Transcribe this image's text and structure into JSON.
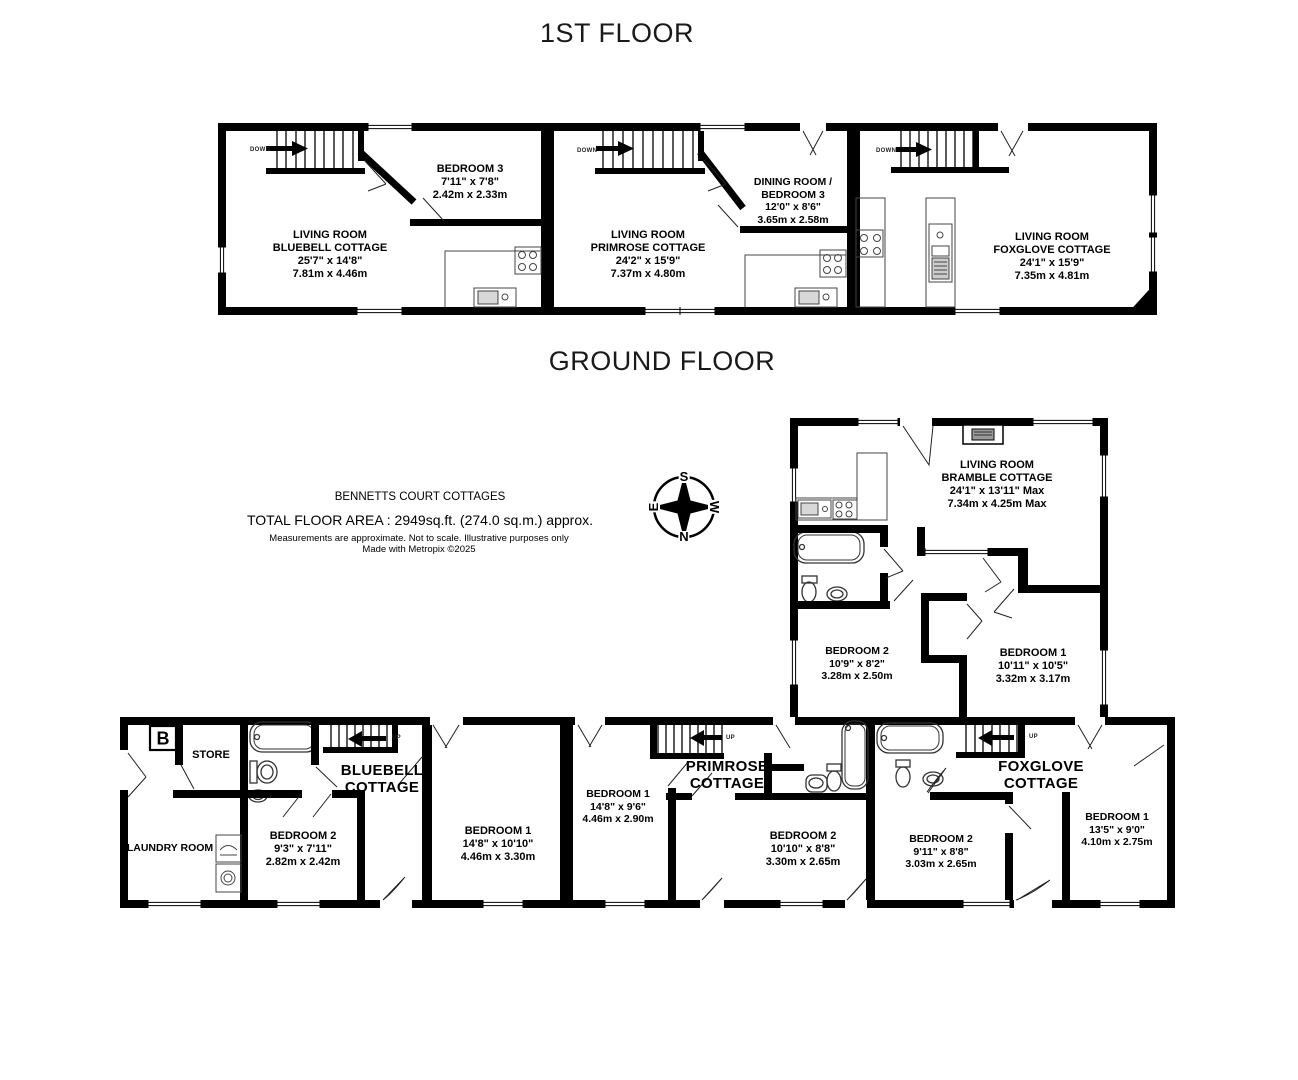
{
  "titles": {
    "first_floor": "1ST FLOOR",
    "ground_floor": "GROUND FLOOR"
  },
  "info": {
    "property_name": "BENNETTS COURT COTTAGES",
    "total_area": "TOTAL FLOOR AREA : 2949sq.ft. (274.0 sq.m.) approx.",
    "disclaimer": "Measurements are approximate.  Not to scale.  Illustrative purposes only",
    "credit": "Made with Metropix ©2025"
  },
  "compass": {
    "north": "N",
    "south": "S",
    "east": "E",
    "west": "W"
  },
  "stairs": {
    "down": "DOWN",
    "up": "UP"
  },
  "boiler": {
    "label": "B"
  },
  "first_floor": {
    "bluebell_living": {
      "lines": [
        "LIVING ROOM",
        "BLUEBELL COTTAGE",
        "25'7\"  x 14'8\"",
        "7.81m  x 4.46m"
      ]
    },
    "bluebell_bedroom3": {
      "lines": [
        "BEDROOM 3",
        "7'11\"  x 7'8\"",
        "2.42m  x 2.33m"
      ]
    },
    "primrose_living": {
      "lines": [
        "LIVING ROOM",
        "PRIMROSE COTTAGE",
        "24'2\"  x 15'9\"",
        "7.37m  x 4.80m"
      ]
    },
    "primrose_dining": {
      "lines": [
        "DINING ROOM /",
        "BEDROOM 3",
        "12'0\"  x 8'6\"",
        "3.65m  x 2.58m"
      ]
    },
    "foxglove_living": {
      "lines": [
        "LIVING ROOM",
        "FOXGLOVE COTTAGE",
        "24'1\"  x 15'9\"",
        "7.35m  x 4.81m"
      ]
    }
  },
  "ground_floor": {
    "bramble_living": {
      "lines": [
        "LIVING ROOM",
        "BRAMBLE COTTAGE",
        "24'1\"  x 13'11\" Max",
        "7.34m  x 4.25m Max"
      ]
    },
    "bramble_bedroom2": {
      "lines": [
        "BEDROOM 2",
        "10'9\"  x 8'2\"",
        "3.28m  x 2.50m"
      ]
    },
    "bramble_bedroom1": {
      "lines": [
        "BEDROOM 1",
        "10'11\"  x 10'5\"",
        "3.32m  x 3.17m"
      ]
    },
    "store": {
      "lines": [
        "STORE"
      ]
    },
    "laundry": {
      "lines": [
        "LAUNDRY ROOM"
      ]
    },
    "bluebell_name": {
      "lines": [
        "BLUEBELL",
        "COTTAGE"
      ]
    },
    "bluebell_bedroom2": {
      "lines": [
        "BEDROOM 2",
        "9'3\"  x 7'11\"",
        "2.82m  x 2.42m"
      ]
    },
    "bluebell_bedroom1": {
      "lines": [
        "BEDROOM 1",
        "14'8\"  x 10'10\"",
        "4.46m  x 3.30m"
      ]
    },
    "primrose_bedroom1": {
      "lines": [
        "BEDROOM 1",
        "14'8\"  x 9'6\"",
        "4.46m  x 2.90m"
      ]
    },
    "primrose_name": {
      "lines": [
        "PRIMROSE",
        "COTTAGE"
      ]
    },
    "primrose_bedroom2": {
      "lines": [
        "BEDROOM 2",
        "10'10\"  x 8'8\"",
        "3.30m  x 2.65m"
      ]
    },
    "foxglove_bedroom2": {
      "lines": [
        "BEDROOM 2",
        "9'11\"  x 8'8\"",
        "3.03m  x 2.65m"
      ]
    },
    "foxglove_name": {
      "lines": [
        "FOXGLOVE",
        "COTTAGE"
      ]
    },
    "foxglove_bedroom1": {
      "lines": [
        "BEDROOM 1",
        "13'5\"  x 9'0\"",
        "4.10m  x 2.75m"
      ]
    }
  }
}
